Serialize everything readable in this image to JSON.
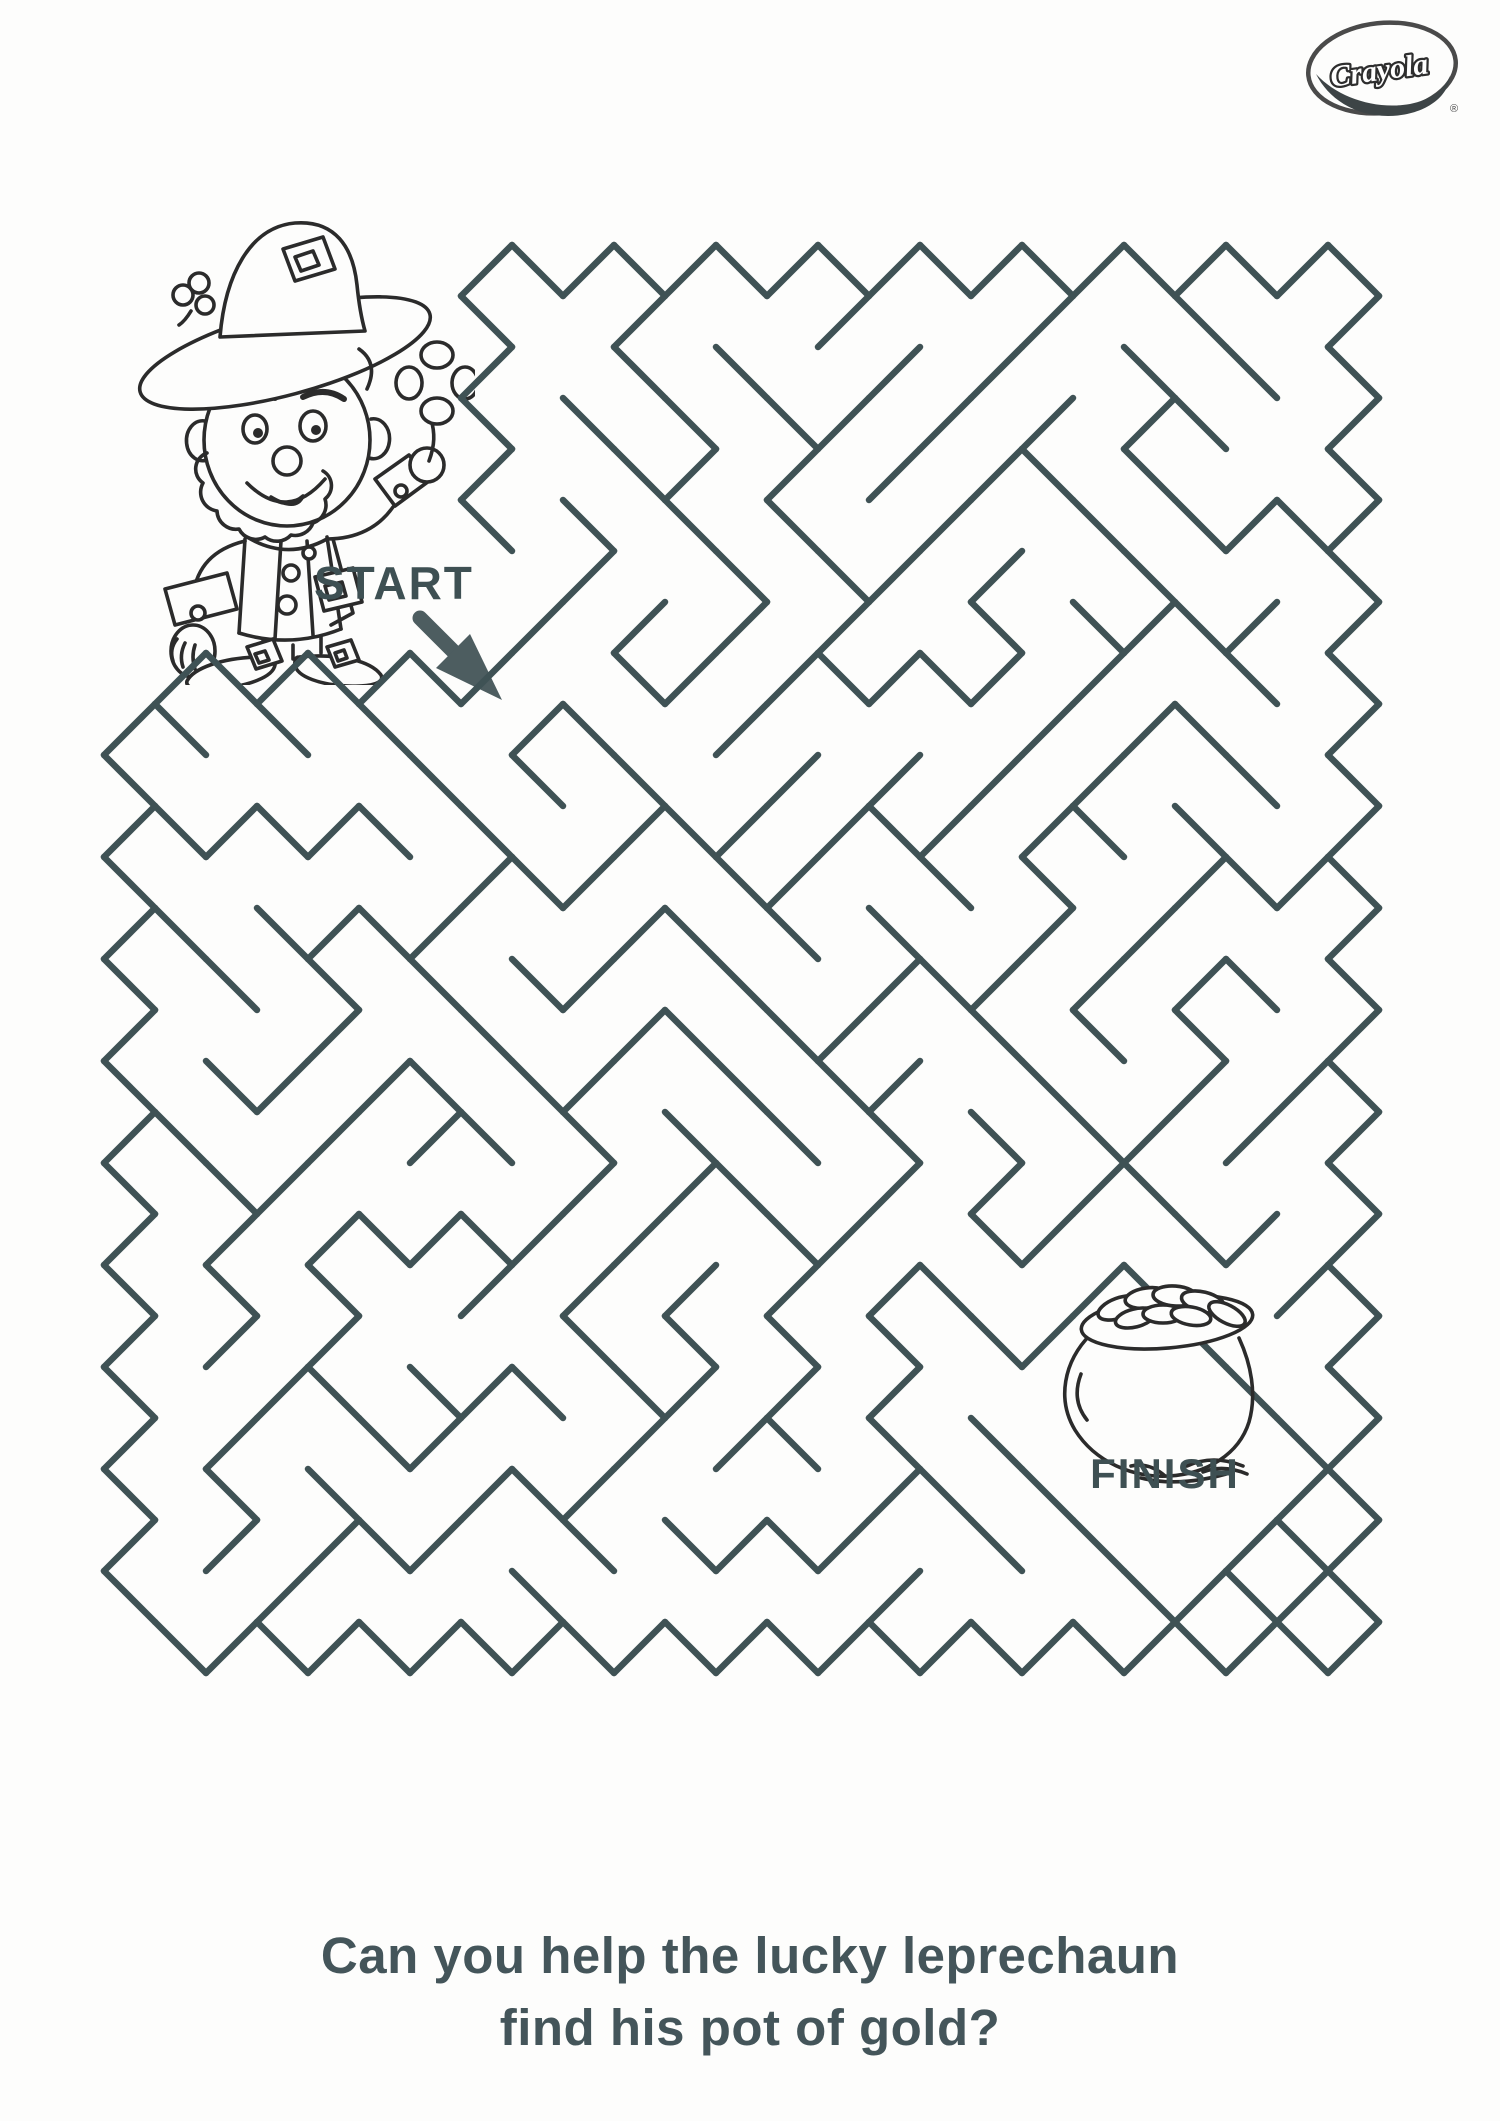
{
  "page": {
    "bg_color": "#fdfdfc",
    "ink_color": "#2b2b2b"
  },
  "logo": {
    "brand": "Crayola",
    "registered_mark": "®",
    "ring_color": "#4a4a4a",
    "swoosh_color": "#3d4446"
  },
  "start": {
    "label": "START",
    "color": "#3e5053"
  },
  "finish": {
    "label": "FINISH",
    "color": "#3e5053"
  },
  "caption": {
    "line1": "Can you help the lucky leprechaun",
    "line2": "find his pot of gold?",
    "color": "#44555a"
  },
  "maze": {
    "color": "#3f5255",
    "stroke_width": 6.5,
    "cell": 51,
    "origin_x": 104,
    "origin_y": 245,
    "cols": 25,
    "rows": 28,
    "seed": 1703,
    "clear_zones": [
      {
        "type": "rect_idx",
        "max_i": 7,
        "max_j": 8
      },
      {
        "type": "diamond",
        "cx": 1150,
        "cy": 1430,
        "r": 185
      }
    ],
    "openings": [
      {
        "x": 487,
        "y": 602,
        "r": 45
      },
      {
        "x": 996,
        "y": 1392,
        "r": 40
      }
    ]
  },
  "icons": {
    "leprechaun": "leprechaun-line-art",
    "pot_of_gold": "pot-of-gold-line-art",
    "start_arrow": "diagonal-down-right-arrow",
    "hat_clover": "clover-sprig",
    "held_clover": "four-leaf-clover"
  },
  "arrow_color": "#4d5d60"
}
